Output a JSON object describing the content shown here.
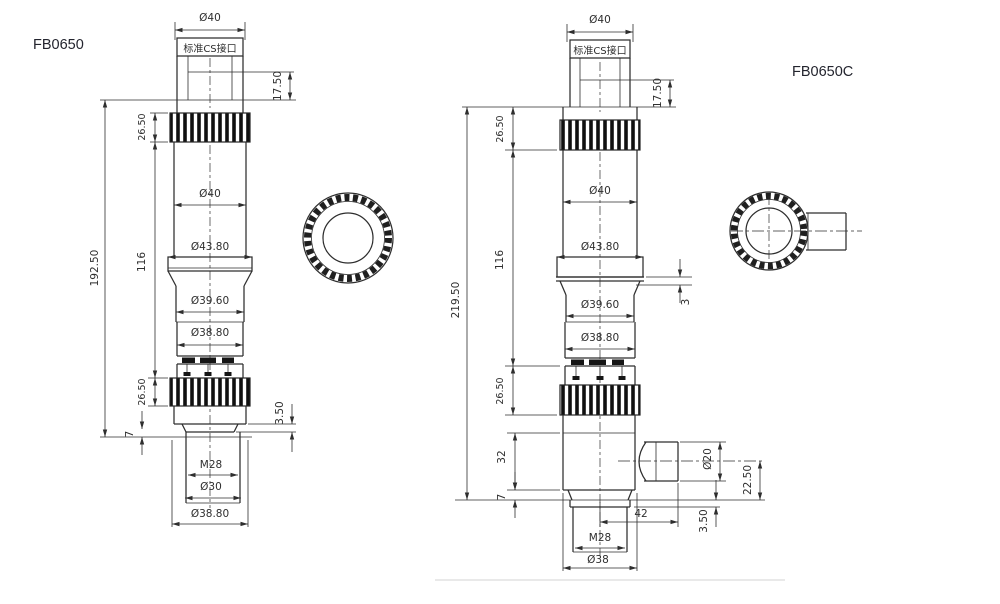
{
  "page": {
    "background": "#ffffff",
    "line_color": "#2e2e2e",
    "label_color": "#23242e"
  },
  "left_view": {
    "label": "FB0650",
    "dims": {
      "top_diameter": "Ø40",
      "cs_mount": "标准CS接口",
      "cs_depth": "17.50",
      "top_knurl_h": "26.50",
      "overall_h": "192.50",
      "mid_h": "116",
      "body_diameter": "Ø40",
      "flange_diameter": "Ø43.80",
      "ring_diameter": "Ø39.60",
      "lower_diameter": "Ø38.80",
      "bottom_knurl_h": "26.50",
      "lip_h": "3.50",
      "base_h": "7",
      "thread": "M28",
      "bore_diameter": "Ø30",
      "base_diameter": "Ø38.80"
    }
  },
  "right_view": {
    "label": "FB0650C",
    "dims": {
      "top_diameter": "Ø40",
      "cs_mount": "标准CS接口",
      "cs_depth": "17.50",
      "top_knurl_h": "26.50",
      "overall_h": "219.50",
      "mid_h": "116",
      "body_diameter": "Ø40",
      "flange_diameter": "Ø43.80",
      "flange_step": "3",
      "ring_diameter": "Ø39.60",
      "lower_diameter": "Ø38.80",
      "bottom_knurl_h": "26.50",
      "lower_body_h": "32",
      "base_h": "7",
      "tube_diameter": "Ø20",
      "tube_center_h": "22.50",
      "tube_length": "42",
      "lip_h": "3.50",
      "thread": "M28",
      "base_diameter": "Ø38"
    }
  }
}
